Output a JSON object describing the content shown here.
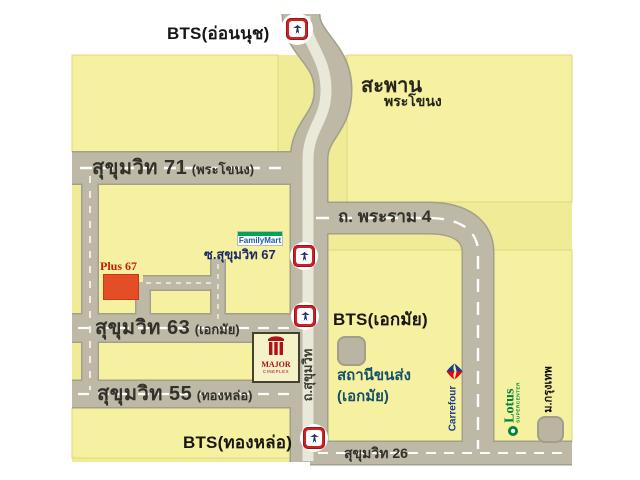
{
  "map": {
    "stations": {
      "onnut_label": "BTS(อ่อนนุช)",
      "ekkamai_label": "BTS(เอกมัย)",
      "thonglor_label": "BTS(ทองหล่อ)"
    },
    "bridge": {
      "line1": "สะพาน",
      "line2": "พระโขนง"
    },
    "roads": {
      "suk71_main": "สุขุมวิท 71",
      "suk71_paren": "(พระโขนง)",
      "rama4": "ถ. พระราม 4",
      "soi67": "ซ.สุขุมวิท 67",
      "suk63_main": "สุขุมวิท 63",
      "suk63_paren": "(เอกมัย)",
      "suk55_main": "สุขุมวิท 55",
      "suk55_paren": "(ทองหล่อ)",
      "suk26": "สุขุมวิท 26",
      "sukhumvit_vertical": "ถ.สุขุมวิท"
    },
    "places": {
      "plus67": "Plus 67",
      "familymart": "FamilyMart",
      "bus_terminal_line1": "สถานีขนส่ง",
      "bus_terminal_line2": "(เอกมัย)",
      "major_line1": "MAJOR",
      "major_line2": "CINEPLEX",
      "carrefour": "Carrefour",
      "lotus_line1": "Lotus",
      "lotus_line2": "SUPERCENTER",
      "bangkok_university": "ม.กรุงเทพ"
    },
    "colors": {
      "map_background": "#efeb97",
      "block_fill": "#f5f1a1",
      "road_gray": "#bdb9a6",
      "road_stripe": "#eae8d8",
      "bts_red": "#ce2027",
      "bts_logo_navy": "#232e6b",
      "plus67_red": "#e44d26",
      "familymart_green": "#00a54f",
      "familymart_blue": "#155ca8",
      "bus_label_blue": "#17506a",
      "lotus_green": "#00843d",
      "carrefour_blue": "#1a3a8c",
      "carrefour_red": "#e30613",
      "major_red": "#b01116"
    }
  }
}
